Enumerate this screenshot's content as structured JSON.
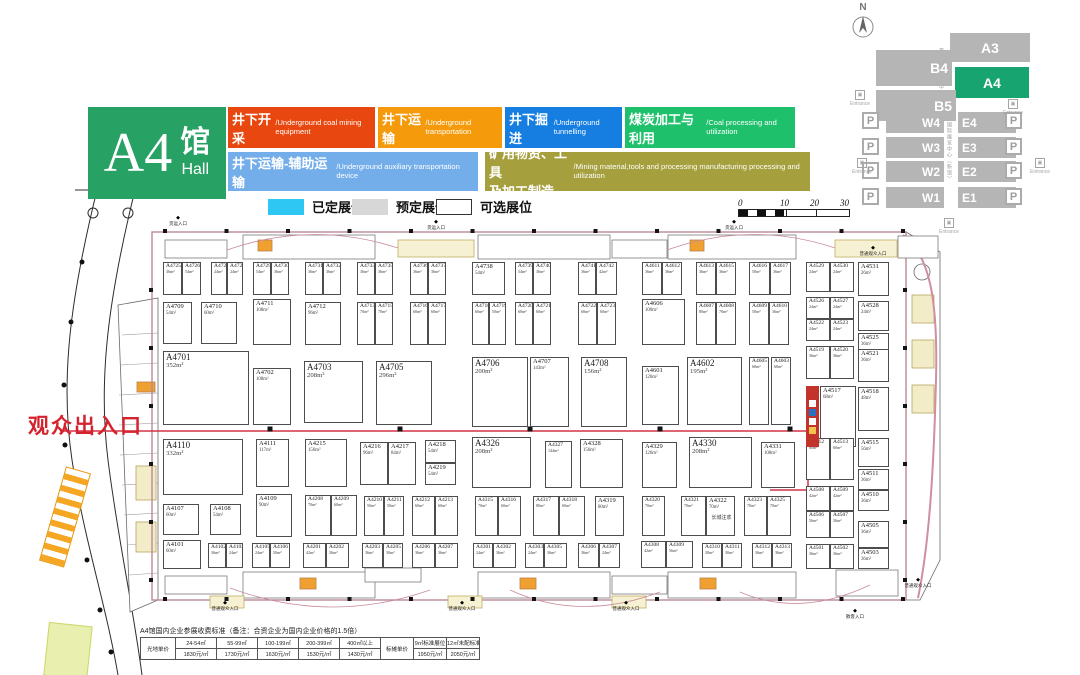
{
  "header": {
    "hall_number": "A4",
    "hall_cn": "馆",
    "hall_en": "Hall"
  },
  "categories": [
    {
      "cn": "井下开采",
      "en": "/Underground coal mining equipment",
      "color": "#e8470f",
      "x": 228,
      "y": 107,
      "w": 147,
      "h": 41
    },
    {
      "cn": "井下运输",
      "en": "/Underground transportation",
      "color": "#f49a0b",
      "x": 378,
      "y": 107,
      "w": 124,
      "h": 41
    },
    {
      "cn": "井下掘进",
      "en": "/Underground tunnelling",
      "color": "#157ee0",
      "x": 505,
      "y": 107,
      "w": 117,
      "h": 41
    },
    {
      "cn": "煤炭加工与利用",
      "en": "/Coal processing and utilization",
      "color": "#1fc06c",
      "x": 625,
      "y": 107,
      "w": 170,
      "h": 41
    },
    {
      "cn": "井下运输-辅助运输",
      "en": "/Underground auxiliary transportation device",
      "color": "#74aeea",
      "x": 228,
      "y": 152,
      "w": 250,
      "h": 39
    },
    {
      "cn": "矿用物资、工具\n及加工制造",
      "en": "/Mining material,tools and processing manufacturing  processing and utilization",
      "color": "#a59f3d",
      "x": 485,
      "y": 152,
      "w": 325,
      "h": 39
    }
  ],
  "legend": [
    {
      "label": "已定展位",
      "color": "#2ec6f3",
      "border": "none"
    },
    {
      "label": "预定展位",
      "color": "#d7d7d7",
      "border": "none"
    },
    {
      "label": "可选展位",
      "color": "#ffffff",
      "border": "1px solid #333"
    }
  ],
  "legend_positions": [
    [
      268,
      197
    ],
    [
      352,
      197
    ],
    [
      436,
      197
    ]
  ],
  "scale_bar": {
    "ticks": [
      "0",
      "10",
      "20",
      "30"
    ]
  },
  "minimap": {
    "north": "N",
    "parking": "P",
    "entrance": "Entrance",
    "venue_label_1": "首都国际会展中心",
    "venue_label_2": "中国国际展览中心（新馆）",
    "halls": [
      {
        "n": "A3",
        "x": 950,
        "y": 33,
        "w": 80,
        "h": 29,
        "hl": false
      },
      {
        "n": "B4",
        "x": 876,
        "y": 50,
        "w": 76,
        "h": 36,
        "hl": false
      },
      {
        "n": "A4",
        "x": 955,
        "y": 67,
        "w": 74,
        "h": 31,
        "hl": true
      },
      {
        "n": "B5",
        "x": 876,
        "y": 90,
        "w": 80,
        "h": 31,
        "hl": false
      },
      {
        "n": "W4",
        "x": 886,
        "y": 112,
        "w": 58,
        "h": 21,
        "hl": false
      },
      {
        "n": "W3",
        "x": 886,
        "y": 137,
        "w": 58,
        "h": 21,
        "hl": false
      },
      {
        "n": "W2",
        "x": 886,
        "y": 161,
        "w": 58,
        "h": 21,
        "hl": false
      },
      {
        "n": "W1",
        "x": 886,
        "y": 187,
        "w": 58,
        "h": 21,
        "hl": false
      },
      {
        "n": "E4",
        "x": 958,
        "y": 112,
        "w": 58,
        "h": 21,
        "hl": false
      },
      {
        "n": "E3",
        "x": 958,
        "y": 137,
        "w": 58,
        "h": 21,
        "hl": false
      },
      {
        "n": "E2",
        "x": 958,
        "y": 161,
        "w": 58,
        "h": 21,
        "hl": false
      },
      {
        "n": "E1",
        "x": 958,
        "y": 187,
        "w": 58,
        "h": 21,
        "hl": false
      }
    ],
    "parking_spots": [
      [
        862,
        112
      ],
      [
        862,
        138
      ],
      [
        862,
        162
      ],
      [
        862,
        188
      ],
      [
        1005,
        112
      ],
      [
        1005,
        138
      ],
      [
        1005,
        162
      ],
      [
        1005,
        188
      ]
    ],
    "entrances": [
      [
        843,
        90
      ],
      [
        996,
        99
      ],
      [
        845,
        158
      ],
      [
        1023,
        158
      ],
      [
        932,
        218
      ]
    ],
    "hall_color": "#b5b5b5",
    "highlight_color": "#18a470"
  },
  "plan": {
    "visitor_exit": "观众出入口",
    "gates": [
      {
        "t": "货运入口",
        "x": 150,
        "y": 216
      },
      {
        "t": "货运入口",
        "x": 408,
        "y": 220
      },
      {
        "t": "货运入口",
        "x": 706,
        "y": 220
      },
      {
        "t": "普通观众入口",
        "x": 845,
        "y": 246
      },
      {
        "t": "普通观众入口",
        "x": 197,
        "y": 601
      },
      {
        "t": "普通观众入口",
        "x": 434,
        "y": 601
      },
      {
        "t": "普通观众入口",
        "x": 598,
        "y": 601
      },
      {
        "t": "散客入口",
        "x": 827,
        "y": 609
      },
      {
        "t": "普通观众入口",
        "x": 890,
        "y": 578
      }
    ],
    "booked_booth": {
      "x": 806,
      "y": 386,
      "w": 13,
      "h": 61,
      "color": "#c2342b"
    },
    "booths": [
      [
        "A4725",
        36,
        163,
        262,
        19,
        33
      ],
      [
        "A4726",
        54,
        182,
        262,
        19,
        33
      ],
      [
        "A4727",
        24,
        211,
        262,
        16,
        33
      ],
      [
        "A4728",
        24,
        227,
        262,
        16,
        33
      ],
      [
        "A4729",
        54,
        253,
        262,
        18,
        33
      ],
      [
        "A4730",
        36,
        271,
        262,
        18,
        33
      ],
      [
        "A4731",
        36,
        305,
        262,
        18,
        33
      ],
      [
        "A4732",
        36,
        323,
        262,
        18,
        33
      ],
      [
        "A4733",
        36,
        357,
        262,
        18,
        33
      ],
      [
        "A4735",
        36,
        375,
        262,
        18,
        33
      ],
      [
        "A4736",
        36,
        410,
        262,
        18,
        33
      ],
      [
        "A4737",
        36,
        428,
        262,
        18,
        33
      ],
      [
        "A4738",
        54,
        472,
        262,
        33,
        33
      ],
      [
        "A4739",
        54,
        515,
        262,
        18,
        33
      ],
      [
        "A4740",
        36,
        533,
        262,
        18,
        33
      ],
      [
        "A4741",
        36,
        578,
        262,
        18,
        33
      ],
      [
        "A4742",
        42,
        596,
        262,
        21,
        33
      ],
      [
        "A4611",
        36,
        642,
        262,
        20,
        33
      ],
      [
        "A4612",
        36,
        662,
        262,
        20,
        33
      ],
      [
        "A4613",
        36,
        696,
        262,
        20,
        33
      ],
      [
        "A4615",
        36,
        716,
        262,
        20,
        33
      ],
      [
        "A4616",
        50,
        749,
        262,
        21,
        33
      ],
      [
        "A4617",
        36,
        770,
        262,
        21,
        33
      ],
      [
        "A4529",
        24,
        806,
        262,
        24,
        30
      ],
      [
        "A4530",
        24,
        830,
        262,
        24,
        30
      ],
      [
        "A4531",
        26,
        858,
        262,
        31,
        34
      ],
      [
        "A4709",
        54,
        163,
        302,
        29,
        42
      ],
      [
        "A4710",
        60,
        201,
        302,
        36,
        42
      ],
      [
        "A4711",
        108,
        253,
        299,
        38,
        46
      ],
      [
        "A4712",
        96,
        305,
        302,
        36,
        43
      ],
      [
        "A4713",
        70,
        357,
        302,
        18,
        43
      ],
      [
        "A4715",
        70,
        375,
        302,
        18,
        43
      ],
      [
        "A4716",
        60,
        410,
        302,
        18,
        43
      ],
      [
        "A4717",
        60,
        428,
        302,
        18,
        43
      ],
      [
        "A4718",
        60,
        472,
        302,
        17,
        43
      ],
      [
        "A4719",
        50,
        489,
        302,
        17,
        43
      ],
      [
        "A4720",
        60,
        515,
        302,
        18,
        43
      ],
      [
        "A4721",
        60,
        533,
        302,
        18,
        43
      ],
      [
        "A4722",
        60,
        578,
        302,
        19,
        43
      ],
      [
        "A4723",
        60,
        597,
        302,
        19,
        43
      ],
      [
        "A4606",
        100,
        642,
        299,
        43,
        46
      ],
      [
        "A4607",
        80,
        696,
        302,
        20,
        43
      ],
      [
        "A4608",
        70,
        716,
        302,
        20,
        43
      ],
      [
        "A4609",
        50,
        749,
        302,
        20,
        43
      ],
      [
        "A4610",
        36,
        769,
        302,
        20,
        43
      ],
      [
        "A4526",
        24,
        806,
        297,
        24,
        22
      ],
      [
        "A4527",
        24,
        830,
        297,
        24,
        22
      ],
      [
        "A4528",
        24,
        858,
        301,
        31,
        30
      ],
      [
        "A4522",
        24,
        806,
        319,
        24,
        22
      ],
      [
        "A4523",
        24,
        830,
        319,
        24,
        22
      ],
      [
        "A4525",
        36,
        858,
        333,
        31,
        31
      ],
      [
        "A4519",
        36,
        806,
        346,
        24,
        33
      ],
      [
        "A4520",
        36,
        830,
        346,
        24,
        33
      ],
      [
        "A4521",
        36,
        858,
        349,
        31,
        33
      ],
      [
        "A4701",
        352,
        163,
        351,
        86,
        74
      ],
      [
        "A4702",
        108,
        253,
        368,
        38,
        57
      ],
      [
        "A4703",
        208,
        304,
        361,
        59,
        62
      ],
      [
        "A4705",
        296,
        376,
        361,
        56,
        64
      ],
      [
        "A4706",
        200,
        472,
        357,
        56,
        70
      ],
      [
        "A4707",
        143,
        530,
        357,
        39,
        70
      ],
      [
        "A4708",
        156,
        581,
        357,
        46,
        70
      ],
      [
        "A4601",
        126,
        642,
        366,
        37,
        59
      ],
      [
        "A4602",
        195,
        687,
        357,
        55,
        68
      ],
      [
        "A4605",
        68,
        749,
        357,
        20,
        68
      ],
      [
        "A4603",
        68,
        771,
        357,
        20,
        68
      ],
      [
        "A4517",
        68,
        820,
        386,
        36,
        61
      ],
      [
        "A4518",
        48,
        858,
        387,
        31,
        44
      ],
      [
        "A4110",
        332,
        163,
        439,
        80,
        56
      ],
      [
        "A4111",
        117,
        256,
        439,
        33,
        48
      ],
      [
        "A4215",
        156,
        305,
        439,
        42,
        48
      ],
      [
        "A4216",
        96,
        360,
        442,
        28,
        43
      ],
      [
        "A4217",
        84,
        388,
        442,
        28,
        43
      ],
      [
        "A4218",
        54,
        425,
        440,
        31,
        23
      ],
      [
        "A4219",
        54,
        425,
        463,
        31,
        22
      ],
      [
        "A4326",
        208,
        472,
        437,
        59,
        51
      ],
      [
        "A4327",
        144,
        545,
        441,
        27,
        47
      ],
      [
        "A4328",
        156,
        580,
        439,
        43,
        49
      ],
      [
        "A4329",
        126,
        642,
        442,
        35,
        46
      ],
      [
        "A4330",
        208,
        689,
        437,
        63,
        51
      ],
      [
        "A4331",
        108,
        761,
        442,
        34,
        46
      ],
      [
        "A4512",
        60,
        806,
        438,
        24,
        42
      ],
      [
        "A4513",
        60,
        830,
        438,
        24,
        42
      ],
      [
        "A4515",
        56,
        858,
        438,
        31,
        29
      ],
      [
        "A4511",
        36,
        858,
        469,
        31,
        21
      ],
      [
        "A4510",
        36,
        858,
        490,
        31,
        21
      ],
      [
        "A4508",
        42,
        806,
        486,
        24,
        25
      ],
      [
        "A4509",
        42,
        830,
        486,
        24,
        25
      ],
      [
        "A4506",
        56,
        806,
        511,
        24,
        27
      ],
      [
        "A4507",
        36,
        830,
        511,
        24,
        27
      ],
      [
        "A4505",
        36,
        858,
        521,
        31,
        27
      ],
      [
        "A4503",
        36,
        858,
        548,
        31,
        21
      ],
      [
        "A4501",
        36,
        806,
        544,
        24,
        25
      ],
      [
        "A4502",
        36,
        830,
        544,
        24,
        25
      ],
      [
        "A4107",
        60,
        163,
        504,
        36,
        31
      ],
      [
        "A4108",
        54,
        210,
        504,
        31,
        31
      ],
      [
        "A4109",
        90,
        256,
        494,
        36,
        43
      ],
      [
        "A4208",
        70,
        305,
        495,
        26,
        41
      ],
      [
        "A4209",
        60,
        331,
        495,
        26,
        41
      ],
      [
        "A4210",
        50,
        364,
        496,
        20,
        40
      ],
      [
        "A4211",
        50,
        384,
        496,
        20,
        40
      ],
      [
        "A4212",
        60,
        412,
        496,
        23,
        40
      ],
      [
        "A4213",
        60,
        435,
        496,
        23,
        40
      ],
      [
        "A4315",
        70,
        475,
        496,
        23,
        40
      ],
      [
        "A4316",
        60,
        498,
        496,
        23,
        40
      ],
      [
        "A4317",
        80,
        533,
        496,
        26,
        40
      ],
      [
        "A4318",
        60,
        559,
        496,
        26,
        40
      ],
      [
        "A4319",
        80,
        595,
        496,
        29,
        40
      ],
      [
        "A4320",
        70,
        642,
        496,
        23,
        40
      ],
      [
        "A4321",
        70,
        681,
        496,
        25,
        40
      ],
      [
        "A4322",
        70,
        706,
        496,
        29,
        40,
        "长城注浆"
      ],
      [
        "A4323",
        70,
        744,
        496,
        23,
        40
      ],
      [
        "A4325",
        70,
        767,
        496,
        24,
        40
      ],
      [
        "A4101",
        60,
        163,
        540,
        38,
        29
      ],
      [
        "A4102",
        36,
        208,
        543,
        18,
        25
      ],
      [
        "A4103",
        24,
        226,
        543,
        17,
        25
      ],
      [
        "A4105",
        24,
        252,
        543,
        18,
        25
      ],
      [
        "A4106",
        50,
        270,
        543,
        20,
        25
      ],
      [
        "A4201",
        42,
        303,
        543,
        23,
        25
      ],
      [
        "A4202",
        36,
        326,
        543,
        23,
        25
      ],
      [
        "A4203",
        36,
        362,
        543,
        21,
        25
      ],
      [
        "A4205",
        30,
        383,
        543,
        20,
        25
      ],
      [
        "A4206",
        36,
        412,
        543,
        23,
        25
      ],
      [
        "A4207",
        36,
        435,
        543,
        23,
        25
      ],
      [
        "A4301",
        24,
        473,
        543,
        20,
        25
      ],
      [
        "A4302",
        36,
        493,
        543,
        23,
        25
      ],
      [
        "A4303",
        24,
        525,
        543,
        19,
        25
      ],
      [
        "A4305",
        36,
        544,
        543,
        23,
        25
      ],
      [
        "A4306",
        36,
        578,
        543,
        21,
        25
      ],
      [
        "A4307",
        24,
        599,
        543,
        21,
        25
      ],
      [
        "A4308",
        42,
        641,
        541,
        25,
        27
      ],
      [
        "A4309",
        56,
        666,
        541,
        27,
        27
      ],
      [
        "A4310",
        30,
        702,
        543,
        20,
        25
      ],
      [
        "A4311",
        30,
        722,
        543,
        20,
        25
      ],
      [
        "A4312",
        36,
        752,
        543,
        20,
        25
      ],
      [
        "A4313",
        36,
        772,
        543,
        20,
        25
      ]
    ]
  },
  "price_table": {
    "title": "A4馆国内企业参展收费标准（备注：合资企业为国内企业价格的1.5倍）",
    "raw_header": "光地单价",
    "raw_cols": [
      {
        "range": "24-54㎡",
        "price": "1830元/㎡"
      },
      {
        "range": "55-99㎡",
        "price": "1730元/㎡"
      },
      {
        "range": "100-199㎡",
        "price": "1630元/㎡"
      },
      {
        "range": "200-399㎡",
        "price": "1530元/㎡"
      },
      {
        "range": "400㎡以上",
        "price": "1430元/㎡"
      }
    ],
    "std_header": "标摊单价",
    "std_cols": [
      {
        "range": "9㎡标准展位",
        "price": "1950元/㎡"
      },
      {
        "range": "12㎡未配标准展位",
        "price": "2050元/㎡"
      }
    ]
  }
}
